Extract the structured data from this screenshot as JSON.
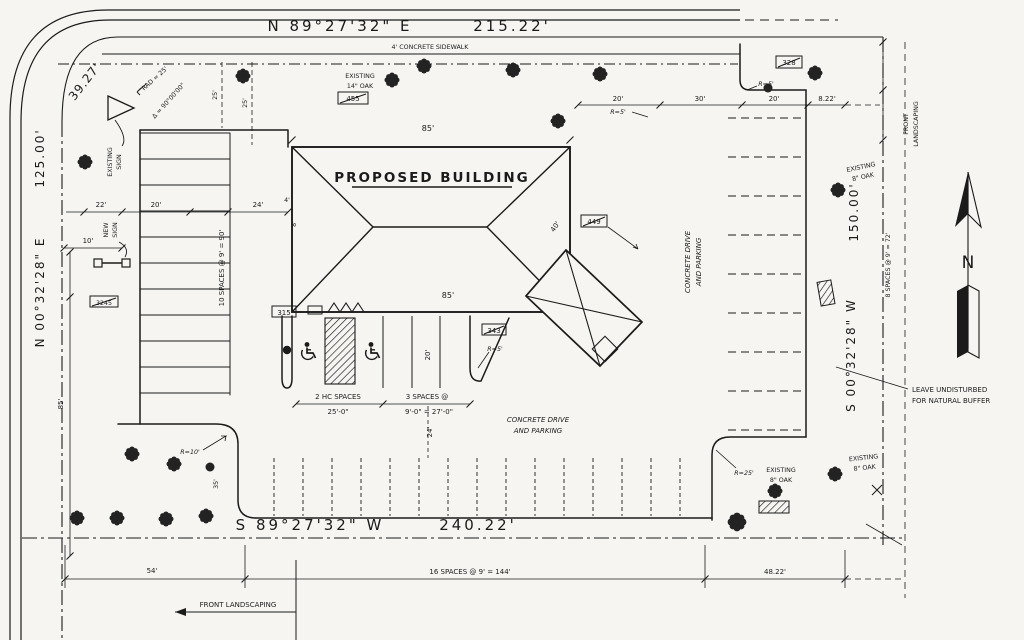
{
  "drawing": {
    "type": "site plan",
    "colors": {
      "ink": "#1b1b1b",
      "paper": "#f6f5f2"
    }
  },
  "survey": {
    "n_bearing": "N 89°27'32\" E",
    "n_dist": "215.22'",
    "w_bearing": "N 00°32'28\" E",
    "w_dist": "125.00'",
    "e_bearing": "S 00°32'28\" W",
    "e_dist": "150.00'",
    "s_bearing": "S 89°27'32\" W",
    "s_dist": "240.22'",
    "arc": "39.27'",
    "rad_note": "RAD = 25'",
    "delta_note": "Δ = 90°00'00\""
  },
  "labels": {
    "sidewalk": "4' CONCRETE SIDEWALK",
    "building": "PROPOSED BUILDING",
    "existing_sign_1": "EXISTING",
    "existing_sign_2": "SIGN",
    "new_sign_1": "NEW",
    "new_sign_2": "SIGN",
    "oak14_1": "EXISTING",
    "oak14_2": "14\" OAK",
    "oak8e_1": "EXISTING",
    "oak8e_2": "8\" OAK",
    "oak8s1_1": "EXISTING",
    "oak8s1_2": "8\" OAK",
    "oak8s2_1": "EXISTING",
    "oak8s2_2": "8\" OAK",
    "drive_1": "CONCRETE DRIVE",
    "drive_2": "AND PARKING",
    "buffer_1": "LEAVE UNDISTURBED",
    "buffer_2": "FOR NATURAL BUFFER",
    "fl_bottom": "FRONT LANDSCAPING",
    "fl_right_1": "FRONT",
    "fl_right_2": "LANDSCAPING",
    "north": "N"
  },
  "parking": {
    "left": "10 SPACES @ 9' = 90'",
    "hc_count": "2 HC SPACES",
    "hc_dim": "25'-0\"",
    "std_count": "3 SPACES @",
    "std_dim": "9'-0\" = 27'-0\"",
    "south": "16 SPACES @ 9' = 144'",
    "east": "8 SPACES @ 9' = 72'"
  },
  "dims": {
    "d10": "10'",
    "d22": "22'",
    "d20nw": "20'",
    "d24nw": "24'",
    "d25a": "25'",
    "d25b": "25'",
    "d85w": "85'",
    "d35": "35'",
    "d85top": "85'",
    "d85bot": "85'",
    "d4": "4'",
    "d8": "8'",
    "d40": "40'",
    "d20stall": "20'",
    "d24aisle": "24'",
    "d20ne1": "20'",
    "d30": "30'",
    "d20ne2": "20'",
    "d822": "8.22'",
    "d54": "54'",
    "d4822": "48.22'"
  },
  "radii": {
    "r10": "R=10'",
    "r5a": "R=5'",
    "r5b": "R=5'",
    "r5c": "R=5'",
    "r25": "R=25'"
  },
  "spots": {
    "a455": "455",
    "b328": "328",
    "c449": "449",
    "d315": "315",
    "e343": "343",
    "f3245": "3245"
  }
}
